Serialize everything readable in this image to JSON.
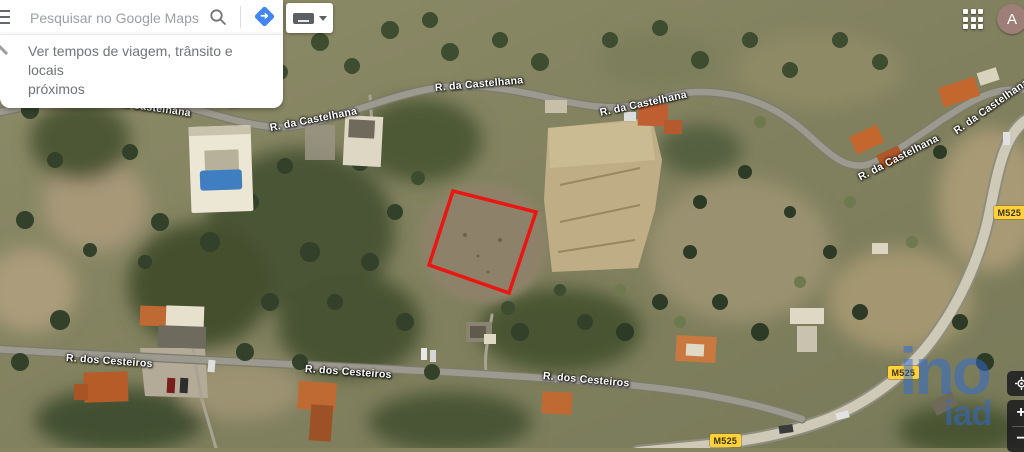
{
  "topbar": {
    "search_placeholder": "Pesquisar no Google Maps",
    "suggestion": {
      "line1": "Ver tempos de viagem, trânsito e locais",
      "line2": "próximos"
    },
    "avatar_letter": "A"
  },
  "map": {
    "labels": {
      "castelhana": "R. da Castelhana",
      "cesteiros": "R. dos Cesteiros",
      "route_badge": "M525"
    },
    "overlay": {
      "boundary_color": "#ea1611",
      "badge_color": "#ffd23c"
    },
    "watermark": {
      "big": "ino",
      "small": "iad",
      "color": "#2d69d7"
    }
  },
  "controls": {
    "zoom_in": "+",
    "zoom_out": "−"
  },
  "colors": {
    "accent_blue": "#4285f4",
    "avatar_bg": "#9d7f78"
  }
}
